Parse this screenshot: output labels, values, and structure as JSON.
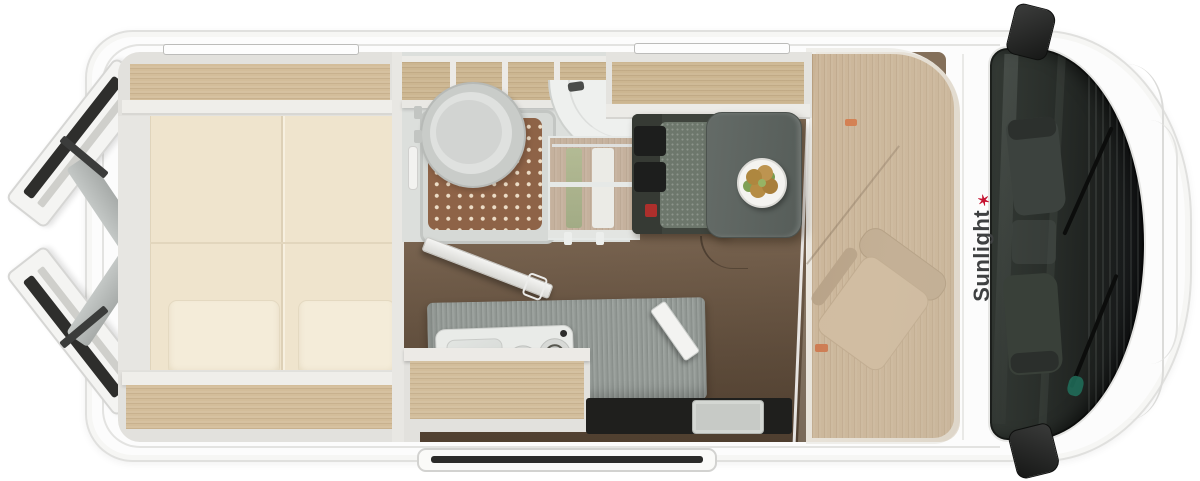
{
  "brand": {
    "logo_text": "Sunlight"
  },
  "palette": {
    "body_white": "#fcfcfc",
    "wall_grey": "#e6e5e1",
    "oak_shelf": "#d3bd9a",
    "bed_cream": "#efe4cd",
    "floor_walnut": "#75614d",
    "cab_floor_oak": "#c6ae8f",
    "shower_mat_brown": "#8e6347",
    "bench_grey_green": "#6d776c",
    "table_grey": "#5e6561",
    "counter_grey": "#9aa09c",
    "windshield_glass_dark": "#1d211e",
    "accent_red": "#c51230",
    "accent_orange": "#d2622a"
  }
}
